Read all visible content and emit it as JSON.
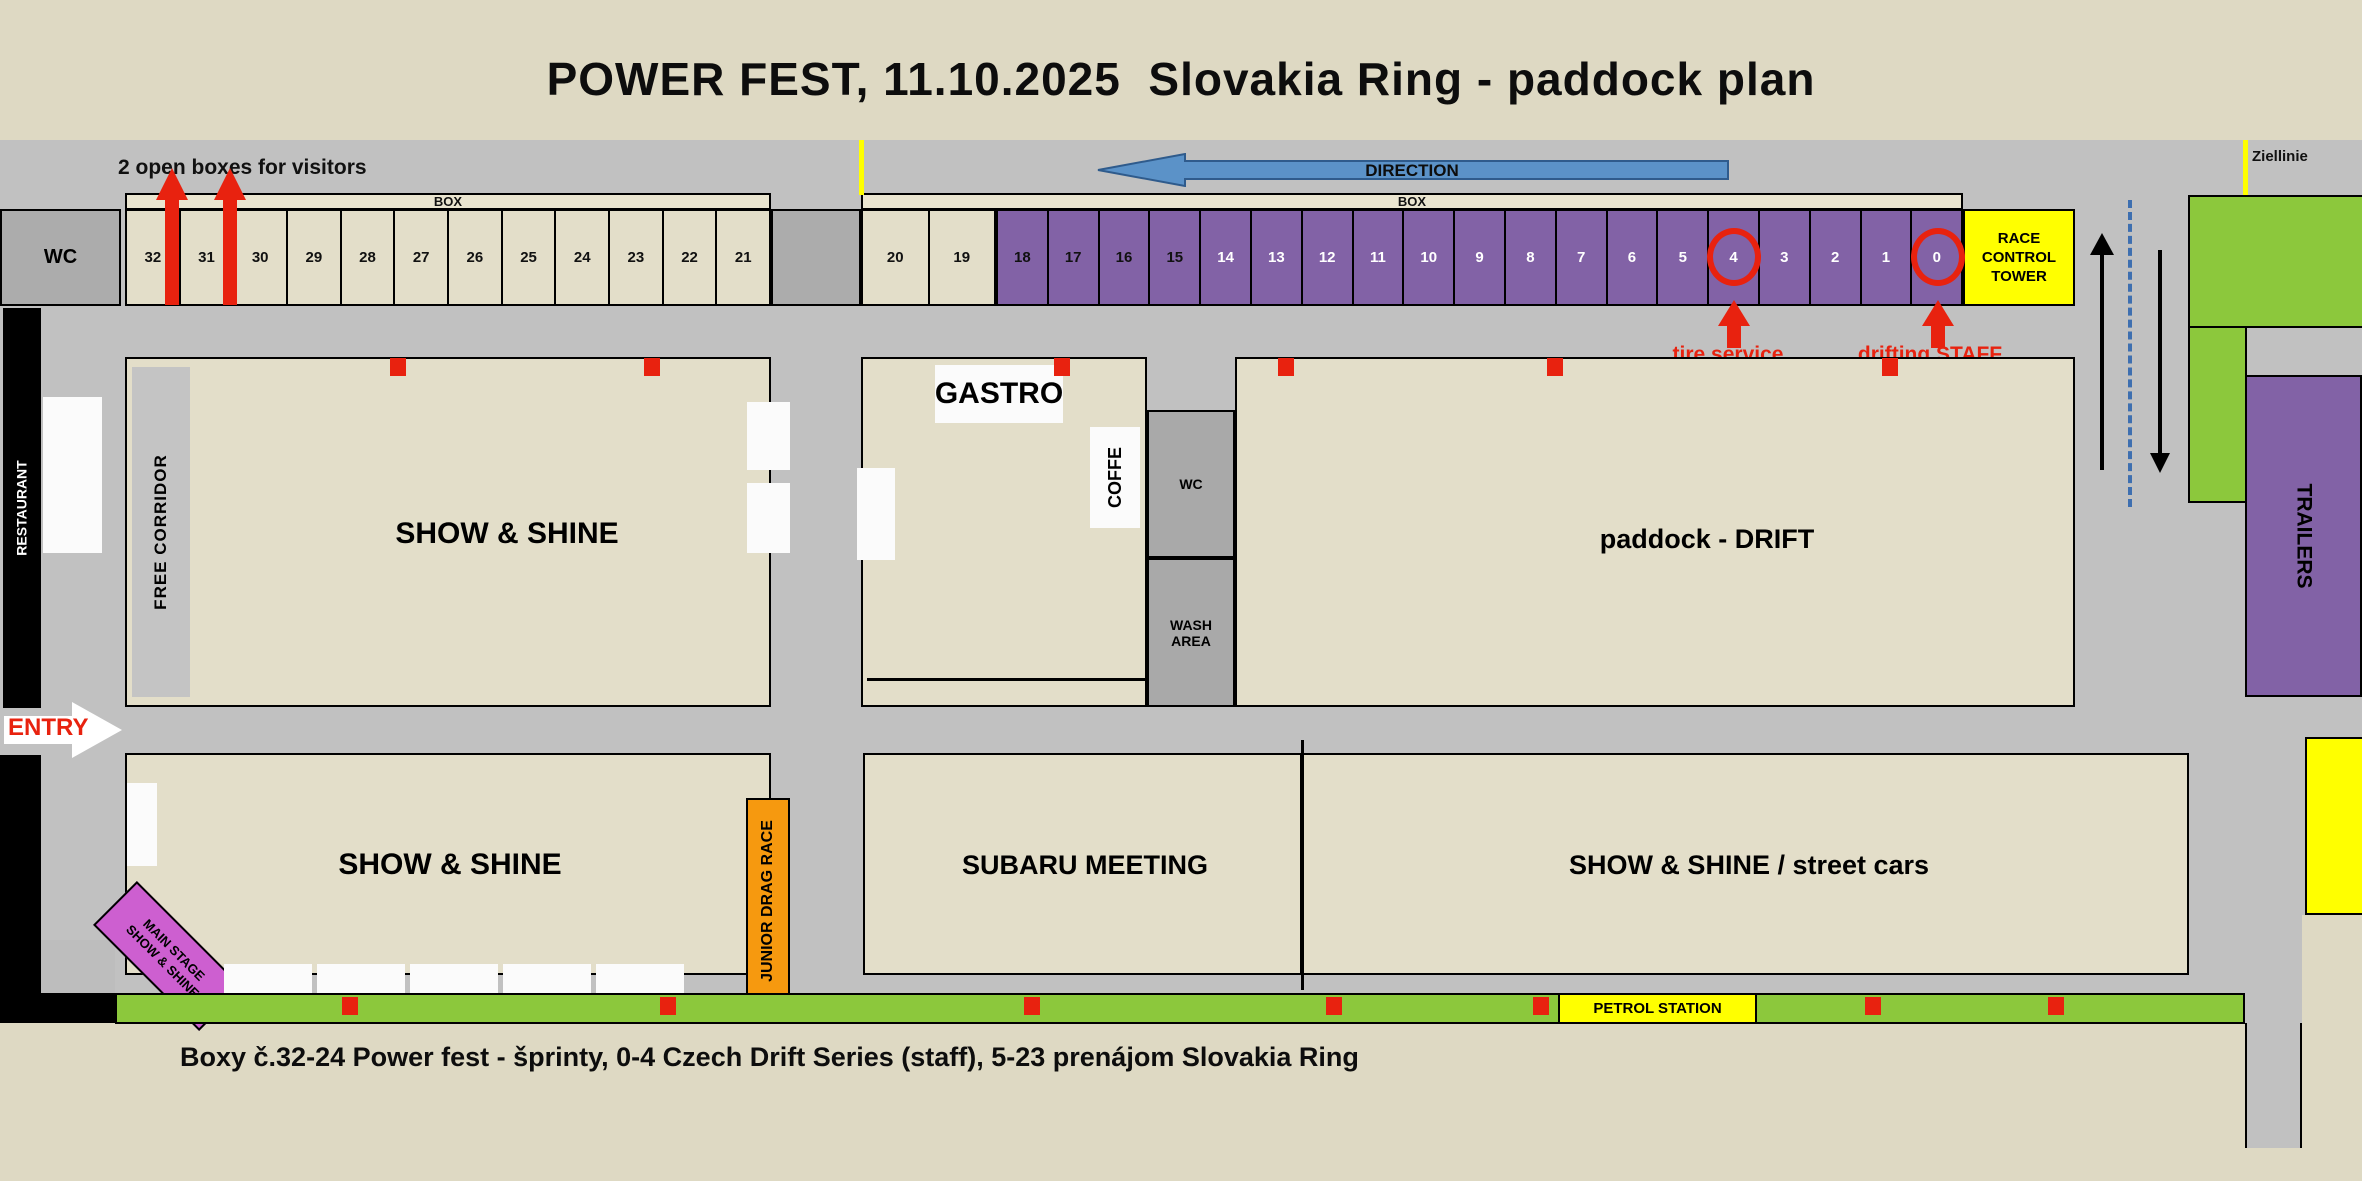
{
  "title": "POWER FEST, 11.10.2025  Slovakia Ring - paddock plan",
  "colors": {
    "purple": "#8262A6",
    "green": "#8CC83C",
    "yellow": "#FFFF00",
    "red": "#E8220F",
    "orange": "#F6990F",
    "magenta": "#CD5FD0",
    "blue_arrow": "#5B92C8",
    "road_gray": "#C1C1C1",
    "box_beige": "#E3DEC9"
  },
  "top": {
    "visitors_note": "2 open boxes for visitors",
    "box_label_left": "BOX",
    "box_label_right": "BOX",
    "wc_label": "WC",
    "beige_box_numbers": [
      "32",
      "31",
      "30",
      "29",
      "28",
      "27",
      "26",
      "25",
      "24",
      "23",
      "22",
      "21"
    ],
    "beige_box_numbers_right": [
      "20",
      "19"
    ],
    "purple_box_numbers": [
      "18",
      "17",
      "16",
      "15",
      "14",
      "13",
      "12",
      "11",
      "10",
      "9",
      "8",
      "7",
      "6",
      "5",
      "4",
      "3",
      "2",
      "1",
      "0"
    ],
    "race_control_tower": "RACE CONTROL TOWER",
    "direction": "DIRECTION",
    "ziellinie": "Ziellinie",
    "tire_service": "tire service",
    "drifting_staff": "drifting STAFF"
  },
  "left": {
    "restaurant": "RESTAURANT",
    "entry": "ENTRY"
  },
  "areas": {
    "free_corridor": "FREE CORRIDOR",
    "show_shine_1": "SHOW & SHINE",
    "gastro": "GASTRO",
    "coffe": "COFFE",
    "wc_small": "WC",
    "wash_area": "WASH AREA",
    "paddock_drift": "paddock - DRIFT",
    "show_shine_2": "SHOW & SHINE",
    "junior_drag": "JUNIOR DRAG RACE",
    "subaru": "SUBARU MEETING",
    "street_cars": "SHOW & SHINE / street cars",
    "main_stage_l1": "MAIN STAGE",
    "main_stage_l2": "SHOW & SHINE",
    "petrol": "PETROL STATION",
    "trailers": "TRAILERS"
  },
  "caption": "Boxy č.32-24 Power fest - šprinty, 0-4 Czech Drift Series (staff), 5-23 prenájom Slovakia Ring"
}
